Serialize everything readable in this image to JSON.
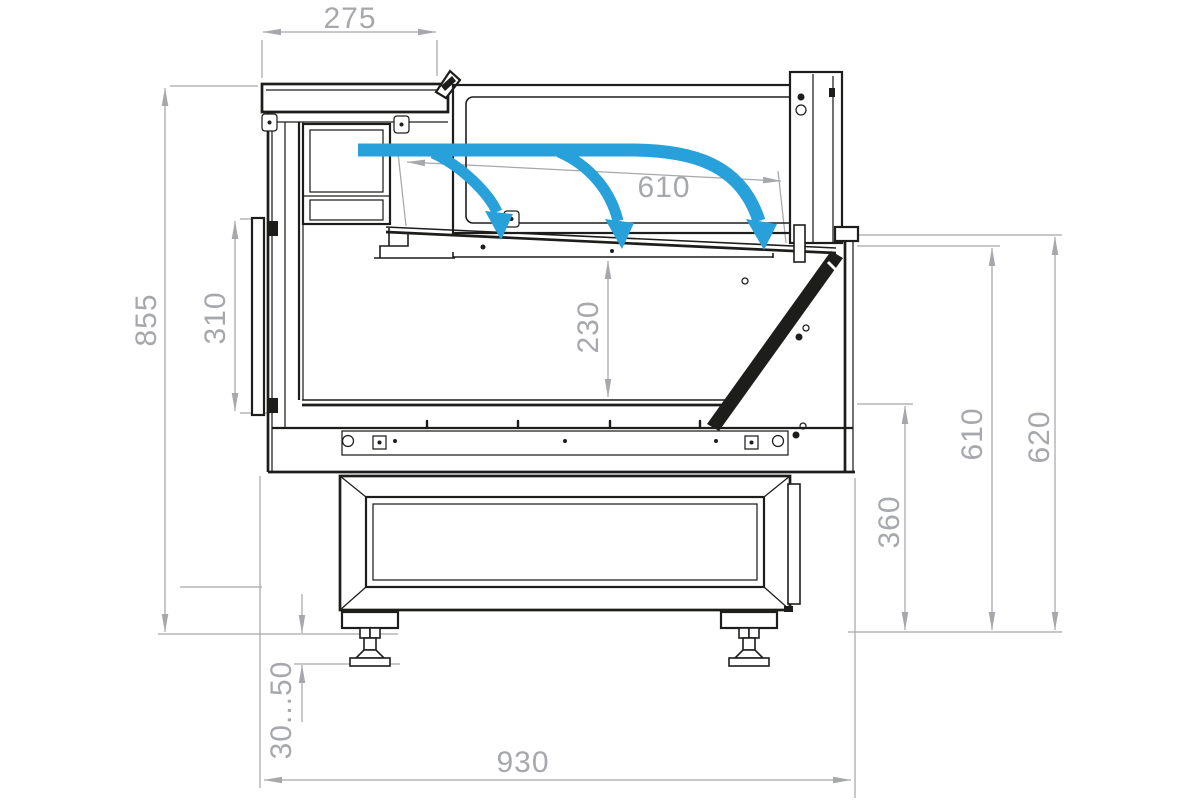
{
  "drawing": {
    "kind": "technical-cross-section",
    "subject": "refrigerated display counter side section with airflow and mounting dimensions"
  },
  "dimensions": {
    "canopy_depth": "275",
    "deck_length": "610",
    "total_height": "855",
    "back_panel_height": "310",
    "display_opening_height": "230",
    "base_section_height": "360",
    "front_inner_height": "610",
    "front_height": "620",
    "feet_adjust_range": "30...50",
    "total_depth": "930"
  },
  "colors": {
    "airflow_blue": "#28a0da",
    "dimension_gray": "#a6a8ab",
    "drawing_line": "#1d1d1b",
    "background": "#ffffff"
  }
}
